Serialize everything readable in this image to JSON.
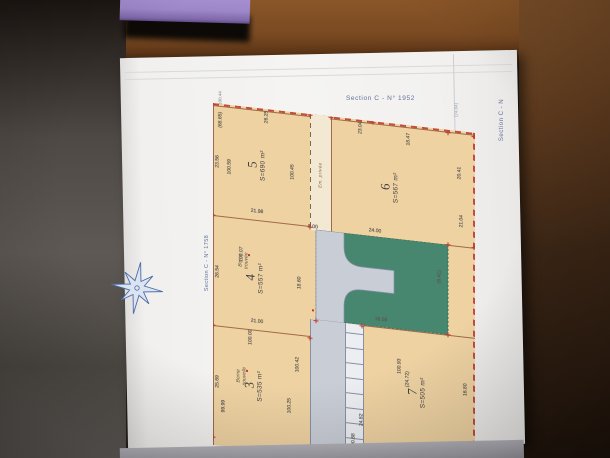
{
  "scene": {
    "table": {
      "wood_color": "#7a4c24",
      "shadow_color": "#241911"
    },
    "purple_object_color": "#9d86c9",
    "background_left_color": "#4a4542",
    "bottom_edge_color": "#a19fa7"
  },
  "paper": {
    "color": "#f3f2ef",
    "labels": {
      "top_right": "Section C - N° 1952",
      "left_vertical": "Section C - N° 1758",
      "right_vertical": "Section C - N",
      "right_tick": "(24.04)",
      "left_top_tick": "100.44"
    }
  },
  "plan": {
    "street_label": "Em. privée",
    "colors": {
      "parcel_fill": "#eed2a2",
      "boundary_line": "#a2684a",
      "outer_dash": "#c24e3a",
      "green_area": "#47876f",
      "road_fill": "#c9cdd6",
      "passage_fill": "#f3e8d2",
      "dim_text": "#5a5550",
      "numeral_text": "#423e46",
      "section_text": "#63719a",
      "marker_red": "#c0392b",
      "compass_blue": "#4b6ca8"
    },
    "parcels": [
      {
        "id": "3",
        "area": "S=535 m²",
        "note": "Borne nouvelle"
      },
      {
        "id": "4",
        "area": "S=557 m²",
        "note": "Borne trouvée"
      },
      {
        "id": "5",
        "area": "S=690 m²",
        "note": ""
      },
      {
        "id": "6",
        "area": "S=567 m²",
        "note": ""
      },
      {
        "id": "7",
        "area": "S=505 m²",
        "note": ""
      }
    ],
    "dimensions": [
      {
        "t": "(68.65)",
        "x": 8,
        "y": 16,
        "r": 1
      },
      {
        "t": "26.25",
        "x": 54,
        "y": 8,
        "r": 1
      },
      {
        "t": "23.56",
        "x": 5,
        "y": 58,
        "r": 1
      },
      {
        "t": "100.59",
        "x": 17,
        "y": 62,
        "r": 1
      },
      {
        "t": "100.45",
        "x": 80,
        "y": 60,
        "r": 1
      },
      {
        "t": "21.98",
        "x": 44,
        "y": 104,
        "r": 0
      },
      {
        "t": "26.54",
        "x": 5,
        "y": 168,
        "r": 1
      },
      {
        "t": "100.07",
        "x": 29,
        "y": 148,
        "r": 1
      },
      {
        "t": "18.60",
        "x": 87,
        "y": 170,
        "r": 1
      },
      {
        "t": "21.00",
        "x": 44,
        "y": 214,
        "r": 0
      },
      {
        "t": "25.69",
        "x": 5,
        "y": 278,
        "r": 1
      },
      {
        "t": "100.00",
        "x": 38,
        "y": 230,
        "r": 1
      },
      {
        "t": "99.99",
        "x": 11,
        "y": 302,
        "r": 1
      },
      {
        "t": "100.25",
        "x": 77,
        "y": 294,
        "r": 1
      },
      {
        "t": "100.42",
        "x": 85,
        "y": 252,
        "r": 1
      },
      {
        "t": "23.04",
        "x": 148,
        "y": 8,
        "r": 1
      },
      {
        "t": "18.47",
        "x": 196,
        "y": 14,
        "r": 1
      },
      {
        "t": "20.41",
        "x": 247,
        "y": 42,
        "r": 1
      },
      {
        "t": "21.04",
        "x": 249,
        "y": 90,
        "r": 1
      },
      {
        "t": "24.00",
        "x": 162,
        "y": 110,
        "r": 0
      },
      {
        "t": "8.00",
        "x": 100,
        "y": 113,
        "r": 0
      },
      {
        "t": "(6.41)",
        "x": 227,
        "y": 148,
        "r": 1
      },
      {
        "t": "18.58",
        "x": 168,
        "y": 198,
        "r": 0
      },
      {
        "t": "100.93",
        "x": 187,
        "y": 242,
        "r": 1
      },
      {
        "t": "(24.72)",
        "x": 195,
        "y": 254,
        "r": 1
      },
      {
        "t": "16.80",
        "x": 253,
        "y": 258,
        "r": 1
      },
      {
        "t": "24.82",
        "x": 149,
        "y": 300,
        "r": 1
      },
      {
        "t": "100.96",
        "x": 193,
        "y": 328,
        "r": 1
      },
      {
        "t": "200.68",
        "x": 141,
        "y": 322,
        "r": 1
      }
    ]
  }
}
